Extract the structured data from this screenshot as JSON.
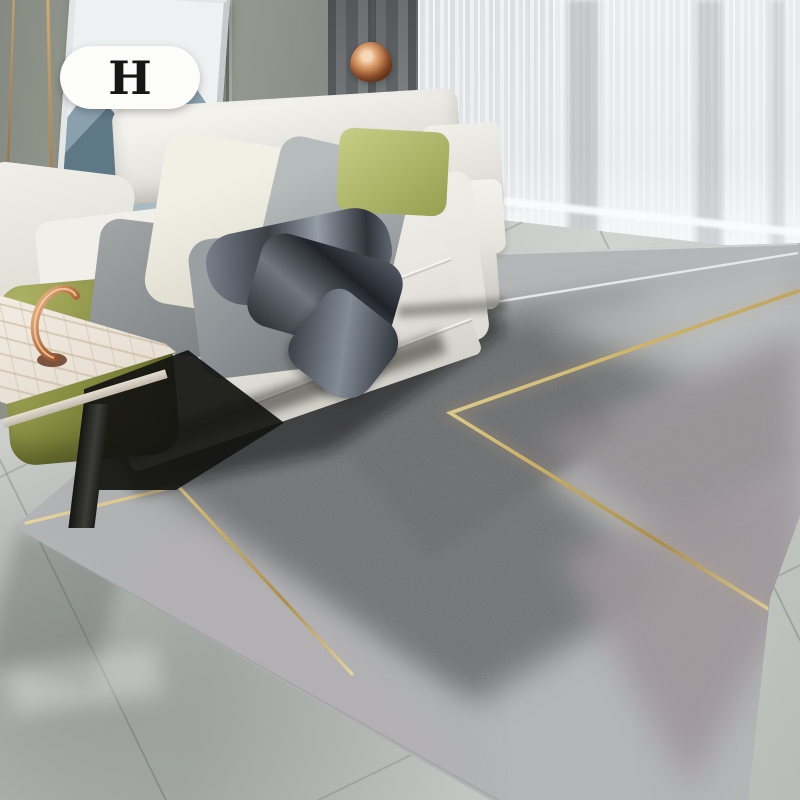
{
  "image_type": "living-room product photo",
  "badge": {
    "label": "H"
  },
  "objects": [
    "wall-panels",
    "mountain-artwork",
    "dark-drape-curtain",
    "sheer-curtain",
    "copper-pendant-lamp",
    "cream-sectional-sofa",
    "olive-pillows",
    "gray-pillows",
    "sage-pillow",
    "satin-throw-blanket",
    "marble-side-table",
    "copper-sculpture",
    "geometric-area-rug",
    "gold-chevron-lines",
    "white-accent-line",
    "marble-tile-floor"
  ],
  "palette": {
    "wall": "#9aa196",
    "dark_curtain": "#6c7073",
    "sheer_curtain": "#eef1f3",
    "sofa_cream": "#edece6",
    "pillow_olive": "#868c40",
    "pillow_sage": "#b4bd75",
    "rug_silver": "#b3b5b7",
    "rug_dark": "#6d6f71",
    "rug_blush": "#9a9295",
    "gold_accent": "#d2b45e",
    "white_line": "#eef1f1",
    "copper": "#b26b41",
    "floor": "#c3c7c3",
    "marble_table": "#efe9df",
    "badge_bg": "#fcfcfb",
    "badge_text": "#161616"
  }
}
